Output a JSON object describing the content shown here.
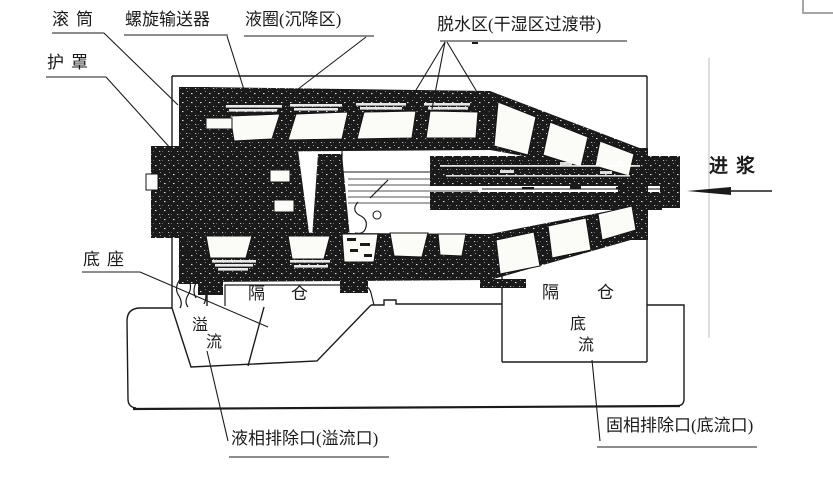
{
  "figure": {
    "labels": {
      "drum": "滚筒",
      "screw_conveyor": "螺旋输送器",
      "liquid_ring": "液圈(沉降区)",
      "dewatering_zone": "脱水区(干湿区过渡带)",
      "guard": "护罩",
      "feed": "进浆",
      "base": "底座",
      "compartment_left": "隔仓",
      "compartment_right": "隔仓",
      "overflow": {
        "full": "溢流",
        "char1": "溢",
        "char2": "流"
      },
      "underflow": {
        "full": "底流",
        "char1": "底",
        "char2": "流"
      },
      "liquid_outlet": "液相排除口(溢流口)",
      "solid_outlet": "固相排除口(底流口)"
    },
    "colors": {
      "ink": "#1b1b1b",
      "paper": "#ffffff",
      "corner_mark": "#a6a6a6",
      "scan_artifact_line": "#cfcfcf"
    }
  }
}
